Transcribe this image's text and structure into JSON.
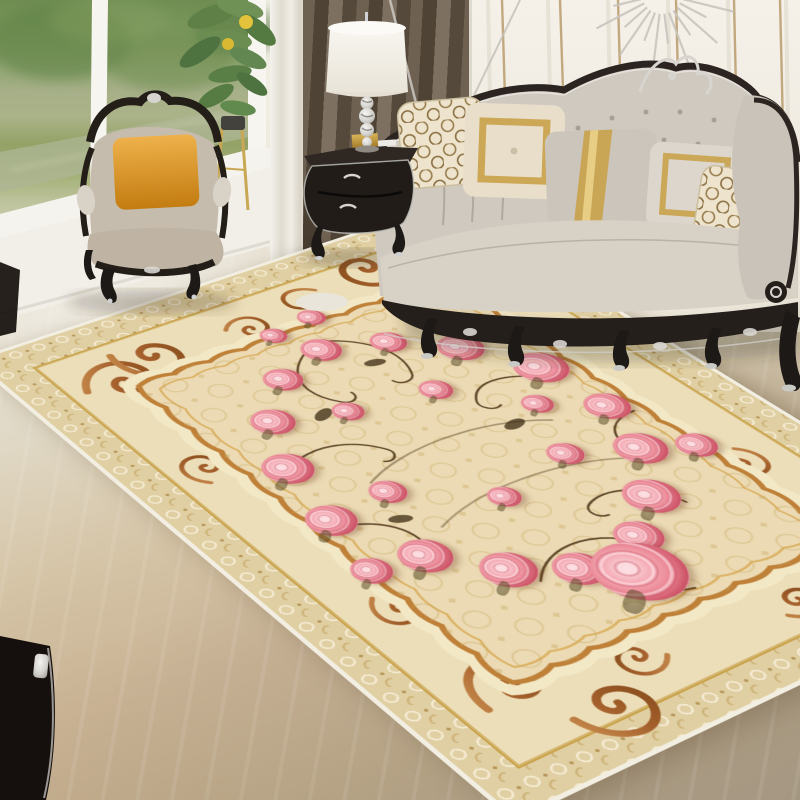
{
  "meta": {
    "description": "Living room product photo: ornate cream European area rug with pink rose wreath, classic carved furniture, garden window",
    "image_type": "natural-photo",
    "visible_text": "none"
  },
  "palette": {
    "wall": "#f2eee5",
    "wall_groove": "#ddd6c8",
    "wall_gold": "#b99c6d",
    "window_frame": "#f7f5f0",
    "trees_dark": "#5d7f46",
    "trees_light": "#8fa86d",
    "lake": "#aeb694",
    "grass": "#8ea05f",
    "grass_light": "#b9bf94",
    "sheer": "#efece5",
    "curtain_dark": "#564a3d",
    "curtain_mid": "#6e6152",
    "marble": "#eae5d8",
    "floor_tan": "#c9b294",
    "floor_grey": "#b3a795",
    "sofa_fabric": "#cfc9c0",
    "sofa_seat": "#d7d1c6",
    "wood_dark": "#241f1b",
    "silver": "#d8d5d0",
    "armchair_fabric": "#c6bcae",
    "pillow_orange_hi": "#eeb14b",
    "pillow_orange_lo": "#c37c10",
    "pillow_hex_bg": "#eee4cd",
    "pillow_hex_line": "#9a7f4f",
    "pillow_gold": "#c9a24b",
    "pillow_grey": "#ccc5bb",
    "pillow_beige": "#e8deca",
    "lamp_shade": "#f8f6f0",
    "rug_binding": "#f2eee2",
    "rug_lace": "#e0cfa2",
    "rug_scrollband": "#ecdeb8",
    "rug_gold": "#c9a24b",
    "rug_brown": "#a5602c",
    "rug_brown_light": "#c98d4e",
    "rug_field": "#ebdab4",
    "rug_damask": "#c8a85f",
    "rose_core": "#c24a5e",
    "rose_dark": "#d95f72",
    "rose_mid": "#ea8291",
    "rose_light": "#f4aab4",
    "rose_pale": "#fbdfe2",
    "stem": "#4a3114",
    "leaf_green": "#5f8148",
    "lemon": "#e3c23c",
    "stand_gold": "#c9a855"
  },
  "scene": {
    "objects": [
      "window with garden and lake view",
      "sheer curtain",
      "dark taupe curtain",
      "white paneled wall with gold strips",
      "silver sunburst wall decor",
      "carved armchair with orange pillow",
      "black bombe nightstand with silver trim",
      "white drum lamp with crystal base",
      "potted lemon plant on gold stand",
      "tufted cream sofa with carved dark wood trim and five pillows",
      "ornate cream floral area rug with pink rose wreath",
      "polished marble floor",
      "dark chair leg in foreground"
    ],
    "sofa_pillows": [
      {
        "name": "honeycomb-left",
        "pattern": "honeycomb",
        "colors": [
          "#eee4cd",
          "#9a7f4f"
        ]
      },
      {
        "name": "gold-square",
        "pattern": "gold square border",
        "colors": [
          "#e8deca",
          "#c9a24b"
        ]
      },
      {
        "name": "gold-sash",
        "pattern": "vertical gold sash",
        "colors": [
          "#ccc5bb",
          "#c9a24b"
        ]
      },
      {
        "name": "gold-border",
        "pattern": "gold frame",
        "colors": [
          "#dcd6cc",
          "#c9a24b"
        ]
      },
      {
        "name": "honeycomb-right",
        "pattern": "honeycomb",
        "colors": [
          "#eee4cd",
          "#9a7f4f"
        ]
      }
    ]
  },
  "rug": {
    "style": "European classic medallion with rose wreath",
    "roses": [
      {
        "x": 50,
        "y": 21,
        "s": 42
      },
      {
        "x": 61,
        "y": 24,
        "s": 38
      },
      {
        "x": 39,
        "y": 24,
        "s": 40
      },
      {
        "x": 30,
        "y": 31,
        "s": 44
      },
      {
        "x": 70,
        "y": 30,
        "s": 48
      },
      {
        "x": 77,
        "y": 39,
        "s": 56
      },
      {
        "x": 24,
        "y": 40,
        "s": 50
      },
      {
        "x": 78,
        "y": 50,
        "s": 46
      },
      {
        "x": 21,
        "y": 51,
        "s": 48
      },
      {
        "x": 74,
        "y": 59,
        "s": 52
      },
      {
        "x": 27,
        "y": 62,
        "s": 50
      },
      {
        "x": 66,
        "y": 67,
        "s": 54
      },
      {
        "x": 35,
        "y": 69,
        "s": 52
      },
      {
        "x": 57,
        "y": 72,
        "s": 46
      },
      {
        "x": 44,
        "y": 73,
        "s": 48
      },
      {
        "x": 51,
        "y": 77,
        "s": 86
      },
      {
        "x": 42,
        "y": 34,
        "s": 32
      },
      {
        "x": 58,
        "y": 36,
        "s": 34
      },
      {
        "x": 63,
        "y": 55,
        "s": 36
      },
      {
        "x": 33,
        "y": 50,
        "s": 36
      },
      {
        "x": 47,
        "y": 58,
        "s": 32
      },
      {
        "x": 69,
        "y": 45,
        "s": 32
      },
      {
        "x": 55,
        "y": 14,
        "s": 30
      },
      {
        "x": 18,
        "y": 61,
        "s": 38
      },
      {
        "x": 82,
        "y": 62,
        "s": 40
      },
      {
        "x": 46,
        "y": 15,
        "s": 28
      }
    ]
  },
  "decor": {
    "sunburst_ray_count": 26,
    "wall_gold_strip_count": 6,
    "sofa_pillow_count": 5
  }
}
